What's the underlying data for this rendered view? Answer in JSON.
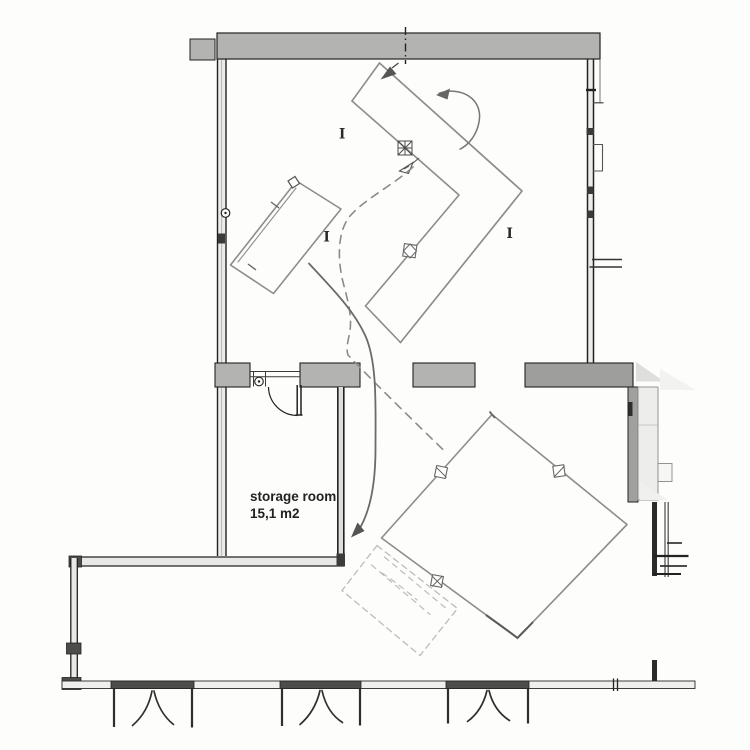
{
  "labels": {
    "storage_room_name": "storage room",
    "storage_room_area": "15,1 m2",
    "column_marker": "I"
  },
  "colors": {
    "paper": "#fdfdfb",
    "ink": "#222220",
    "wall_fill": "#b3b3b1",
    "wall_fill_dark": "#9e9e9c",
    "wall_fill_light": "#ececea",
    "door_band": "#4c4c4a",
    "pencil": "#8d8d8b",
    "pencil_light": "#bcbcba",
    "sketch_dark": "#55554f"
  }
}
